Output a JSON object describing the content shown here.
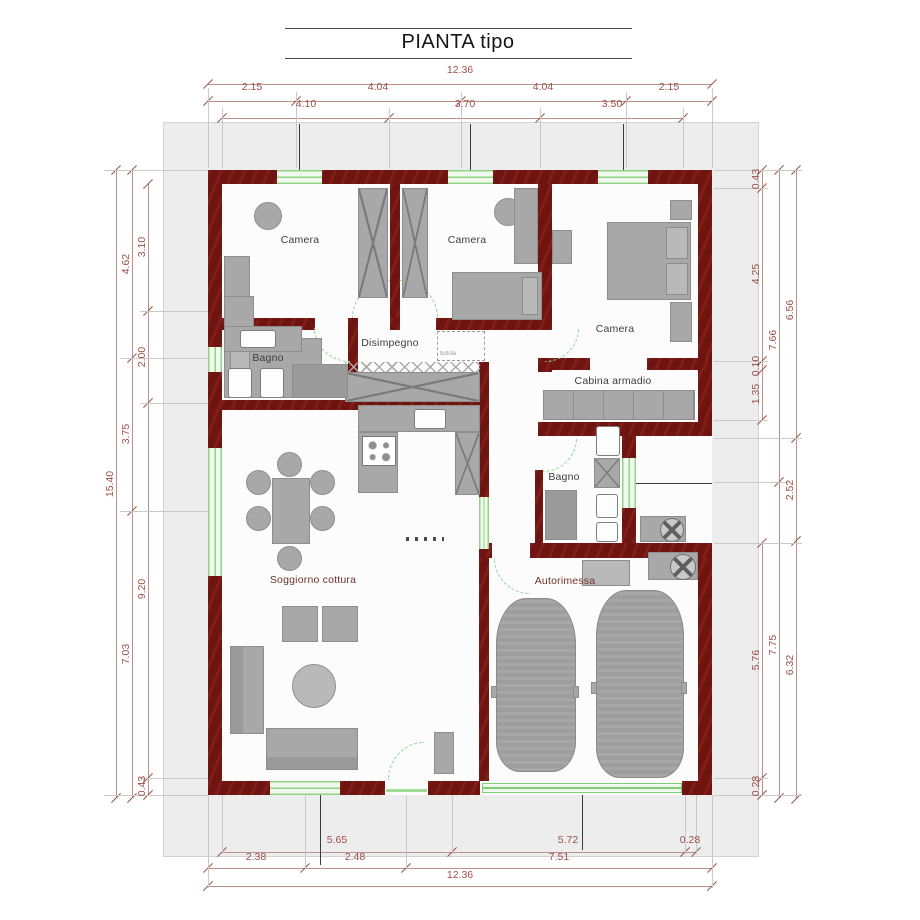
{
  "title": "PIANTA tipo",
  "rooms": {
    "camera1": "Camera",
    "camera2": "Camera",
    "camera3": "Camera",
    "bagno1": "Bagno",
    "bagno2": "Bagno",
    "disimpegno": "Disimpegno",
    "cabina": "Cabina armadio",
    "soggiorno": "Soggiorno cottura",
    "garage": "Autorimessa",
    "hatch": "botola"
  },
  "dimensions": {
    "top": {
      "total": "12.36",
      "row2": [
        "2.15",
        "4.04",
        "4.04",
        "2.15"
      ],
      "row3": [
        "4.10",
        "3.70",
        "3.50"
      ]
    },
    "bottom": {
      "row1": [
        "5.65",
        "5.72",
        "0.28"
      ],
      "row2": [
        "2.38",
        "2.48",
        "7.51"
      ],
      "total": "12.36"
    },
    "left": {
      "total": "15.40",
      "mid": [
        "4.62",
        "3.75",
        "7.03"
      ],
      "inner": [
        "3.10",
        "2.00",
        "9.20",
        "0.43"
      ]
    },
    "right": {
      "inner": [
        "0.43",
        "4.25",
        "0.10",
        "1.35",
        "5.76",
        "0.28"
      ],
      "mid": [
        "7.66",
        "7.75"
      ],
      "outer": [
        "6.56",
        "2.52",
        "6.32"
      ]
    }
  },
  "colors": {
    "wall": "#6e1511",
    "dimension_text": "#9c5048",
    "door_window_green": "#8fd487",
    "furniture_gray": "#a8a8a8",
    "backdrop": "#ededed"
  }
}
